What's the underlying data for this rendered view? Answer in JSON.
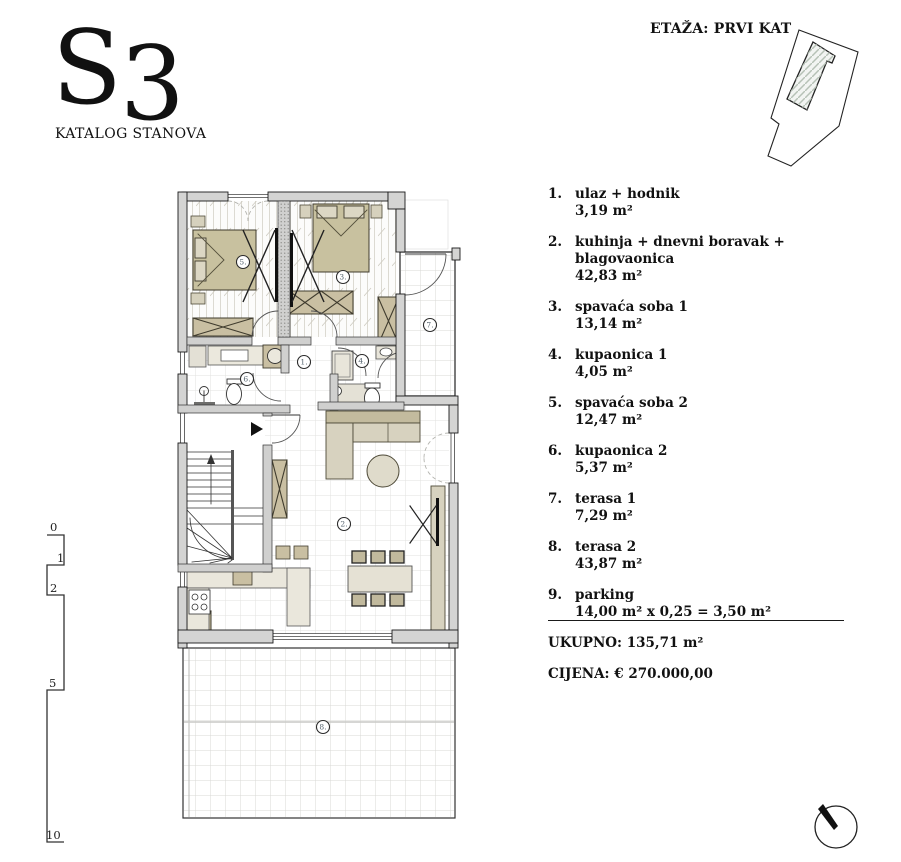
{
  "header": {
    "unit": "S3",
    "catalog": "KATALOG STANOVA"
  },
  "floor_label": "ETAŽA: PRVI KAT",
  "rooms": [
    {
      "num": "1.",
      "name": "ulaz + hodnik",
      "area": "3,19 m²"
    },
    {
      "num": "2.",
      "name": "kuhinja + dnevni boravak + blagovaonica",
      "area": "42,83 m²"
    },
    {
      "num": "3.",
      "name": "spavaća soba 1",
      "area": "13,14 m²"
    },
    {
      "num": "4.",
      "name": "kupaonica 1",
      "area": "4,05 m²"
    },
    {
      "num": "5.",
      "name": "spavaća soba 2",
      "area": "12,47 m²"
    },
    {
      "num": "6.",
      "name": "kupaonica 2",
      "area": "5,37 m²"
    },
    {
      "num": "7.",
      "name": "terasa 1",
      "area": "7,29 m²"
    },
    {
      "num": "8.",
      "name": "terasa 2",
      "area": "43,87 m²"
    },
    {
      "num": "9.",
      "name": "parking",
      "area": "14,00 m² x 0,25 = 3,50 m²"
    }
  ],
  "totals": {
    "ukupno": "UKUPNO: 135,71 m²",
    "cijena": "CIJENA: € 270.000,00"
  },
  "plan": {
    "r1": "1.",
    "r2": "2.",
    "r3": "3.",
    "r4": "4.",
    "r5": "5.",
    "r6": "6.",
    "r7": "7.",
    "r8": "8."
  },
  "scale": {
    "s0": "0",
    "s1": "1",
    "s2": "2",
    "s3": "5",
    "s4": "10"
  },
  "colors": {
    "wall": "#d4d4d3",
    "furniture_tan": "#c9bfa2",
    "furniture_light": "#d7d2bf",
    "counter": "#eae7dc",
    "room_number": "#55636e",
    "grid_line": "#e2e2df",
    "ink": "#1a1a1a"
  }
}
